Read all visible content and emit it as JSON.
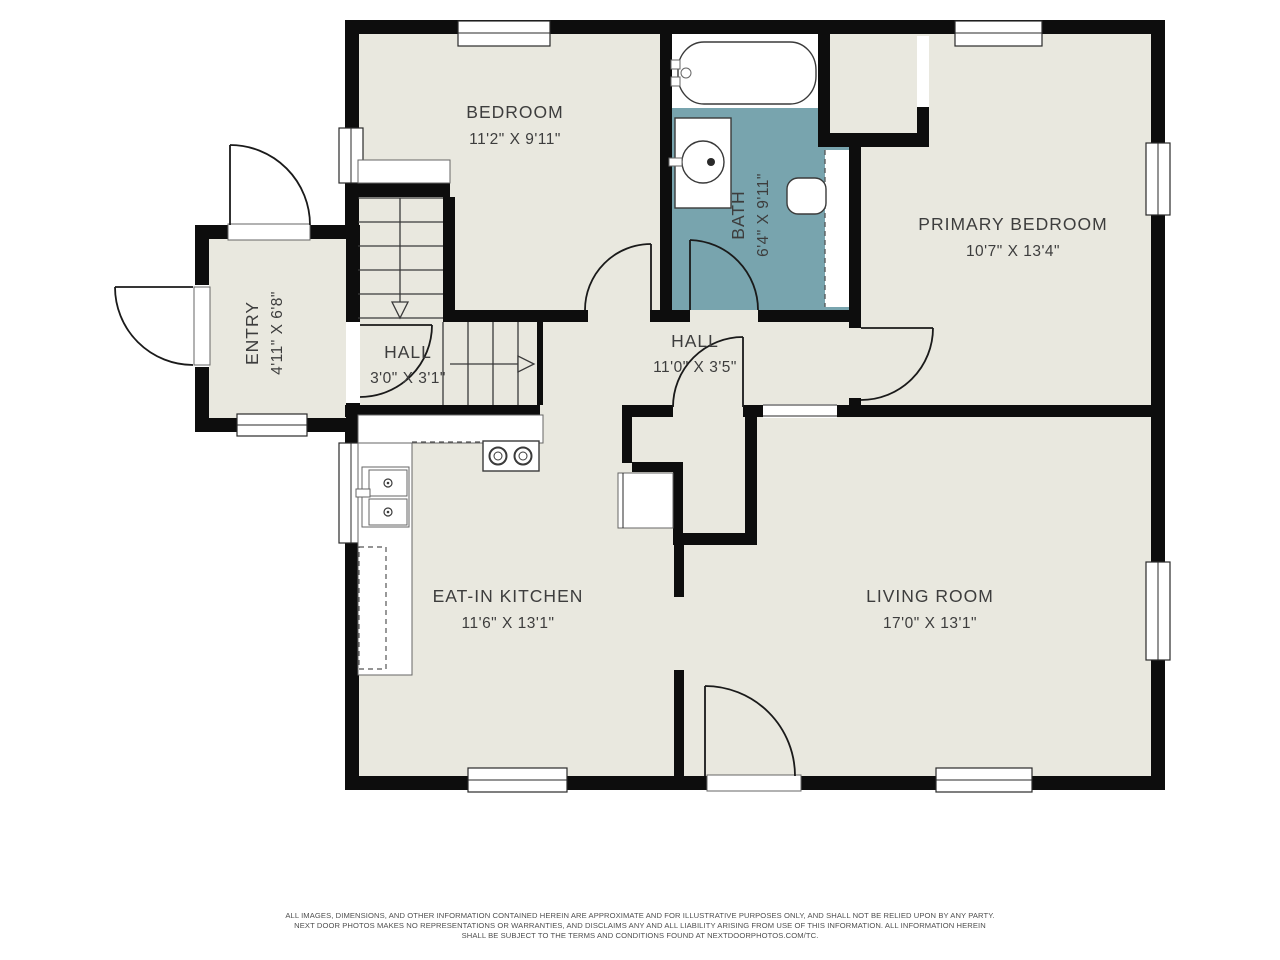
{
  "floorplan": {
    "rooms": {
      "bedroom": {
        "name": "BEDROOM",
        "dims": "11'2\" X 9'11\""
      },
      "bath": {
        "name": "BATH",
        "dims": "6'4\" X 9'11\""
      },
      "primary_bedroom": {
        "name": "PRIMARY BEDROOM",
        "dims": "10'7\" X 13'4\""
      },
      "entry": {
        "name": "ENTRY",
        "dims": "4'11\" X 6'8\""
      },
      "hall_small": {
        "name": "HALL",
        "dims": "3'0\" X 3'1\""
      },
      "hall_main": {
        "name": "HALL",
        "dims": "11'0\" X 3'5\""
      },
      "kitchen": {
        "name": "EAT-IN KITCHEN",
        "dims": "11'6\" X 13'1\""
      },
      "living_room": {
        "name": "LIVING ROOM",
        "dims": "17'0\" X 13'1\""
      }
    },
    "fixtures": {
      "bathtub": "bathtub",
      "bathroom_sink": "bathroom-sink-vanity",
      "toilet": "toilet",
      "kitchen_counter": "kitchen-counter",
      "stove": "stove-two-burners",
      "kitchen_sink": "double-kitchen-sink",
      "refrigerator": "refrigerator-dashed",
      "stairs_down": "stairs-arrow-down",
      "stairs_side": "stairs-arrow-right"
    },
    "colors": {
      "wall": "#0d0d0d",
      "floor": "#e9e8df",
      "bath_floor": "#78a4ae",
      "label_text": "#3d3d3d",
      "background": "#ffffff"
    },
    "disclaimer": {
      "line1": "ALL IMAGES, DIMENSIONS, AND OTHER INFORMATION CONTAINED HEREIN ARE APPROXIMATE AND FOR ILLUSTRATIVE PURPOSES ONLY, AND SHALL NOT BE RELIED UPON BY ANY PARTY.",
      "line2": "NEXT DOOR PHOTOS MAKES NO REPRESENTATIONS OR WARRANTIES, AND DISCLAIMS ANY AND ALL LIABILITY ARISING FROM USE OF THIS INFORMATION. ALL INFORMATION HEREIN",
      "line3": "SHALL BE SUBJECT TO THE TERMS AND CONDITIONS FOUND AT NEXTDOORPHOTOS.COM/TC."
    }
  }
}
